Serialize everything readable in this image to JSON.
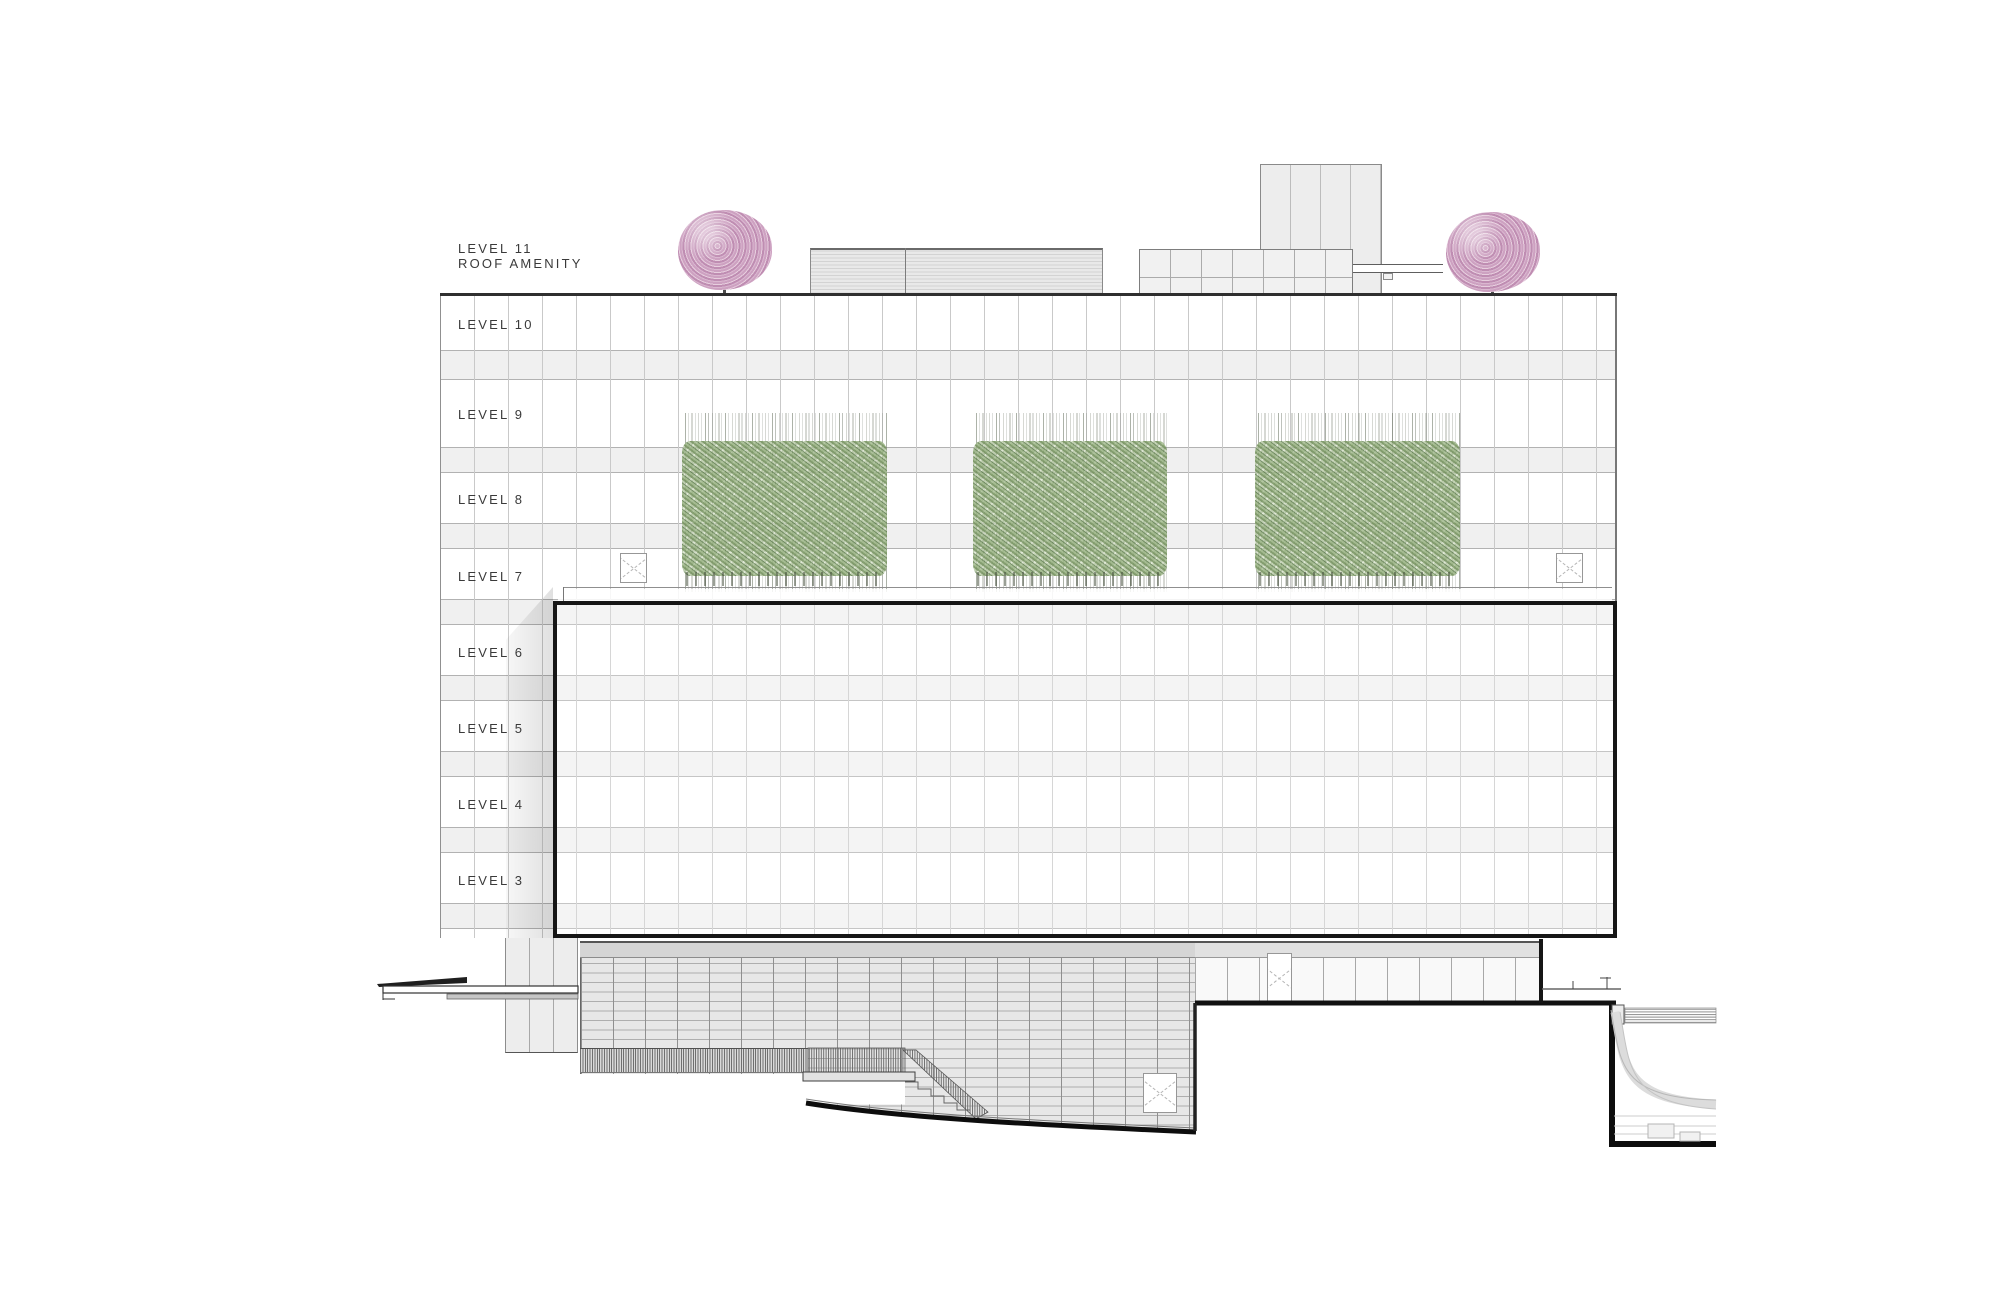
{
  "drawing": {
    "type": "building-elevation",
    "roof_label": {
      "line1": "LEVEL 11",
      "line2": "ROOF AMENITY"
    },
    "levels": [
      {
        "label": "LEVEL 10"
      },
      {
        "label": "LEVEL 9"
      },
      {
        "label": "LEVEL 8"
      },
      {
        "label": "LEVEL 7"
      },
      {
        "label": "LEVEL 6"
      },
      {
        "label": "LEVEL 5"
      },
      {
        "label": "LEVEL 4"
      },
      {
        "label": "LEVEL 3"
      }
    ],
    "vegetation": {
      "bamboo_clusters": 3,
      "roof_trees": 2,
      "bamboo_color": "#8fae7c",
      "tree_color": "#cfa3c3"
    },
    "roof_equipment": [
      "louvered-enclosure",
      "paneled-enclosure",
      "stair-tower",
      "guardrail"
    ],
    "site_elements": [
      "entry-canopy",
      "podium-screen",
      "exterior-stair",
      "sloping-grade",
      "parking-ramp-pit"
    ],
    "colors": {
      "outline_heavy": "#161616",
      "spandrel": "#f0f0f0",
      "podium_grid": "#e7e7e7",
      "ground_line": "#0d0d0d"
    }
  }
}
